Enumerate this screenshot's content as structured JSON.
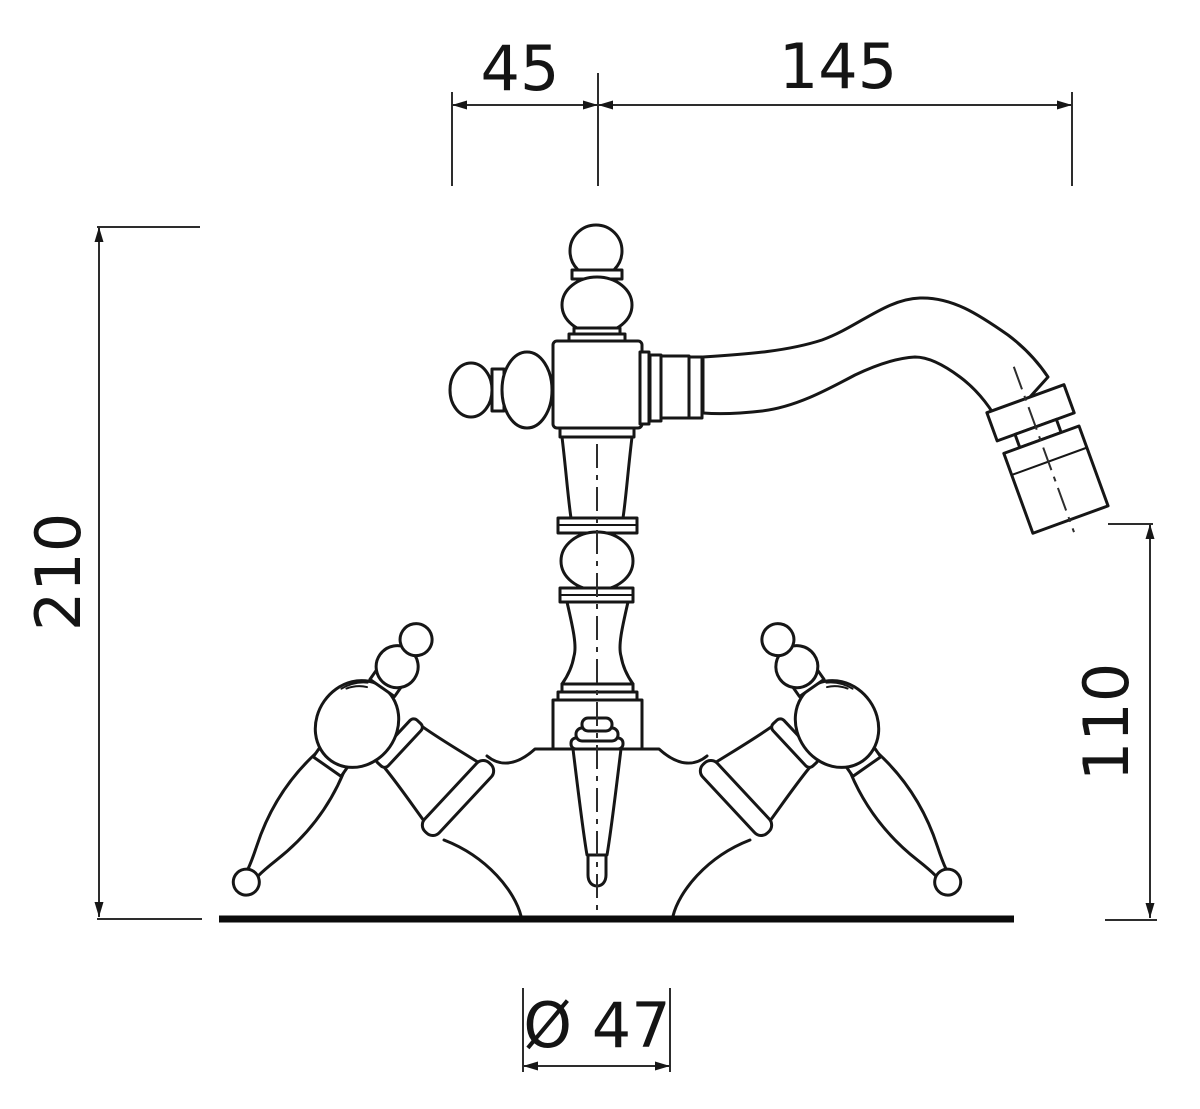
{
  "drawing": {
    "type": "technical-dimension-drawing",
    "subject": "classic two-handle mixer tap with swan-neck spout, side elevation",
    "colors": {
      "line": "#161616",
      "background": "#ffffff"
    },
    "dimensions": {
      "spout_offset": "45",
      "spout_reach": "145",
      "overall_height": "210",
      "outlet_height": "110",
      "base_diameter": "Ø 47"
    }
  }
}
